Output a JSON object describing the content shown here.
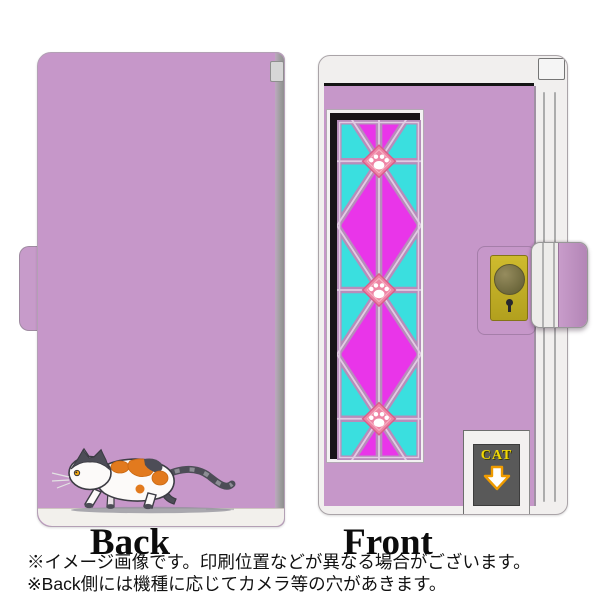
{
  "product": {
    "type": "flip phone case product image",
    "views": {
      "back": {
        "label": "Back"
      },
      "front": {
        "label": "Front"
      }
    },
    "cat_door": {
      "sign_text": "CAT"
    },
    "notes": {
      "line1": "※イメージ画像です。印刷位置などが異なる場合がございます。",
      "line2": "※Back側には機種に応じてカメラ等の穴があきます。"
    },
    "icons": {
      "cat_illustration": "calico-cat-walking-left",
      "paw_print": "white-paw-print-in-pink-diamond",
      "down_arrow": "white-down-arrow-orange-outline",
      "keyhole": "keyhole",
      "door_knob": "round-knob"
    },
    "colors": {
      "case_lavender": "#c697c9",
      "glass_magenta": "#e935e9",
      "glass_cyan": "#3adfdf",
      "lattice_mauve": "#b78dbb",
      "lattice_highlight": "#e2cbe3",
      "paw_diamond_pink": "#ee85a5",
      "lock_plate_yellow": "#c3b027",
      "sign_panel_gray": "#595959",
      "sign_text_yellow": "#f2d803",
      "arrow_orange": "#ef9b00",
      "cat_patch_orange": "#e27a1e",
      "cat_patch_gray": "#4d4d57",
      "frame_black": "#181418",
      "edge_white": "#f1efee"
    }
  }
}
